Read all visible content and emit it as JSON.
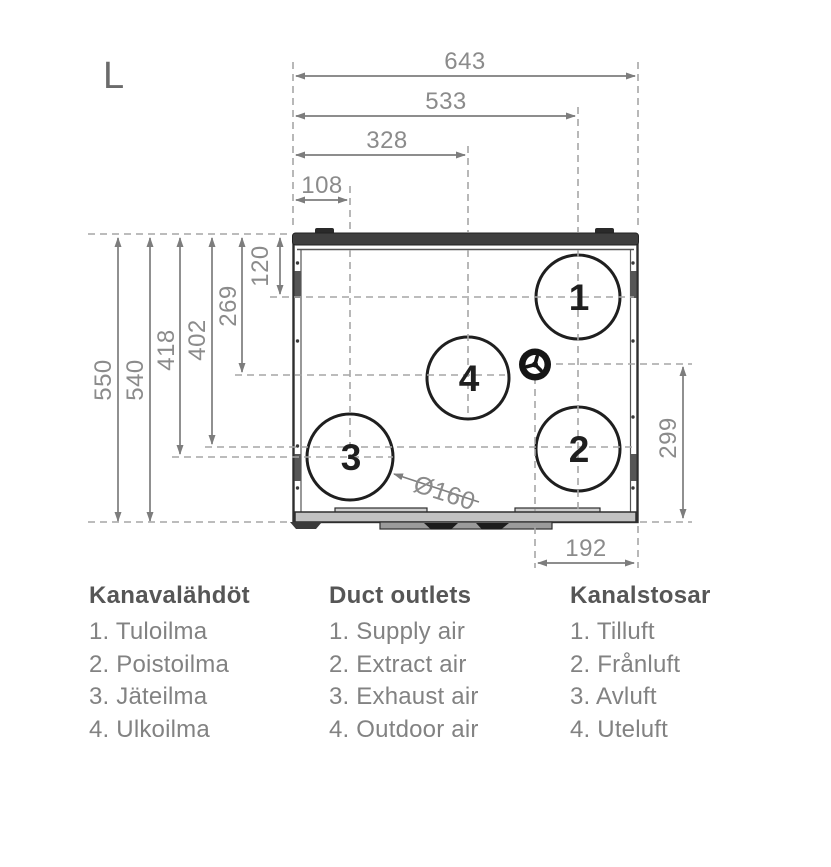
{
  "variant_label": "L",
  "colors": {
    "unit_line": "#2e2e2e",
    "dim_line": "#7d7d7d",
    "dim_text": "#8b8b8b",
    "dash_line": "#a6a6a6",
    "legend_heading": "#565656",
    "legend_item": "#828282",
    "fan_fill": "#151515"
  },
  "diagram": {
    "dims": {
      "top": {
        "d643": "643",
        "d533": "533",
        "d328": "328",
        "d108": "108"
      },
      "left": {
        "d550": "550",
        "d540": "540",
        "d418": "418",
        "d402": "402",
        "d269": "269",
        "d120": "120"
      },
      "right": {
        "d299": "299"
      },
      "bottom": {
        "d192": "192"
      },
      "diameter": "Ø160"
    },
    "outlets": [
      {
        "number": "1"
      },
      {
        "number": "2"
      },
      {
        "number": "3"
      },
      {
        "number": "4"
      }
    ],
    "icons": {
      "fan": "fan-impeller-icon"
    }
  },
  "legend": {
    "columns": [
      {
        "heading": "Kanavalähdöt",
        "items": [
          "1. Tuloilma",
          "2. Poistoilma",
          "3. Jäteilma",
          "4. Ulkoilma"
        ]
      },
      {
        "heading": "Duct outlets",
        "items": [
          "1. Supply air",
          "2. Extract air",
          "3. Exhaust air",
          "4. Outdoor air"
        ]
      },
      {
        "heading": "Kanalstosar",
        "items": [
          "1. Tilluft",
          "2. Frånluft",
          "3. Avluft",
          "4. Uteluft"
        ]
      }
    ]
  }
}
